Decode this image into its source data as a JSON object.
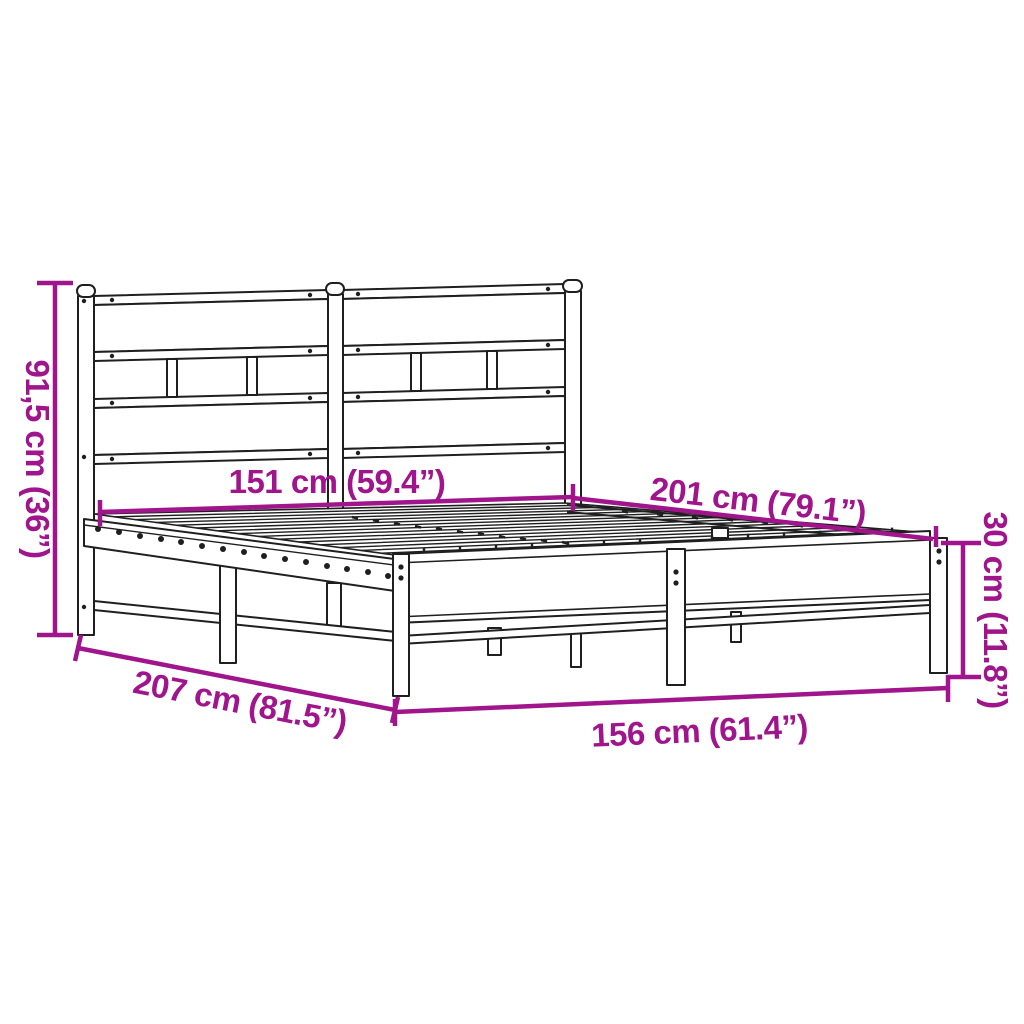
{
  "diagram": {
    "subject": "metal-bed-frame-with-headboard-dimension-diagram",
    "background_color": "#ffffff",
    "line_color": "#1f1f1f",
    "dimension_color": "#a0148c",
    "dimensions": {
      "headboard_height": "91,5 cm (36”)",
      "inner_width": "151 cm (59.4”)",
      "inner_length": "201 cm (79.1”)",
      "base_height": "30 cm (11.8”)",
      "outer_length": "207 cm (81.5”)",
      "outer_width": "156 cm (61.4”)"
    }
  }
}
